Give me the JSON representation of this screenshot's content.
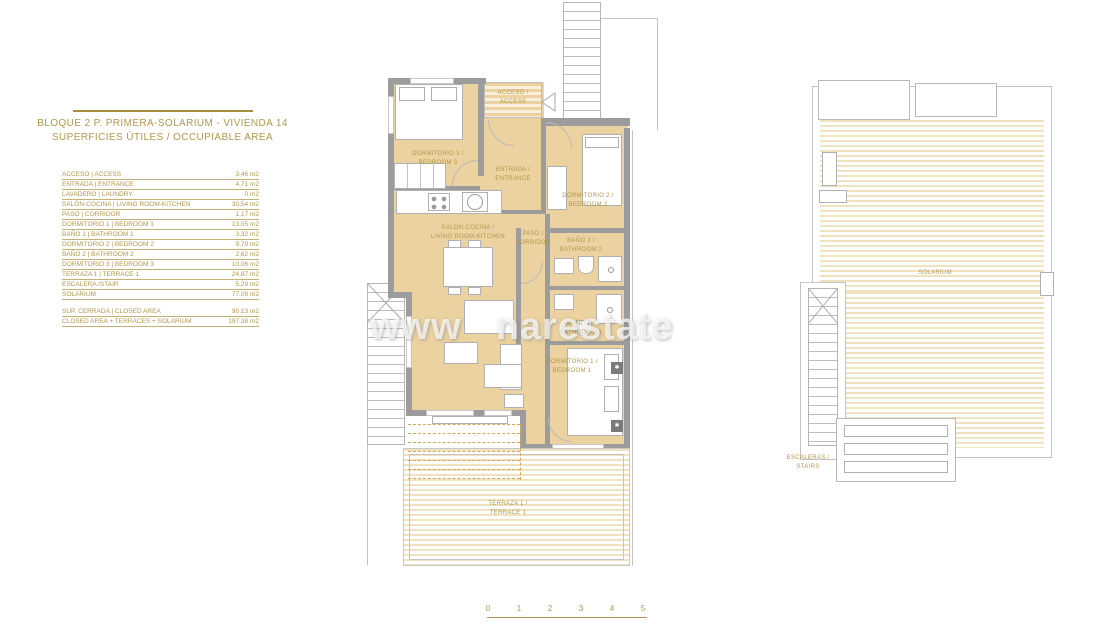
{
  "header": {
    "title_line1": "BLOQUE 2 P. PRIMERA-SOLARIUM - VIVIENDA 14",
    "title_line2": "SUPERFICIES ÚTILES / OCCUPIABLE AREA"
  },
  "area_table": {
    "rows": [
      {
        "label": "ACCESO | ACCESS",
        "value": "3,46 m2"
      },
      {
        "label": "ENTRADA | ENTRANCE",
        "value": "4,71 m2"
      },
      {
        "label": "LAVADERO | LAUNDRY",
        "value": "0 m2"
      },
      {
        "label": "SALÓN-COCINA | LIVING ROOM-KITCHEN",
        "value": "30,54 m2"
      },
      {
        "label": "PASO | CORRIDOR",
        "value": "1,17 m2"
      },
      {
        "label": "DORMITORIO 1 | BEDROOM 1",
        "value": "13,05 m2"
      },
      {
        "label": "BAÑO 1 | BATHROOM 1",
        "value": "3,32 m2"
      },
      {
        "label": "DORMITORIO 2 | BEDROOM 2",
        "value": "9,79 m2"
      },
      {
        "label": "BAÑO 2 | BATHROOM 2",
        "value": "2,62 m2"
      },
      {
        "label": "DORMITORIO 3 | BEDROOM 3",
        "value": "10,06 m2"
      },
      {
        "label": "TERRAZA 1 | TERRACE 1",
        "value": "24,87 m2"
      },
      {
        "label": "ESCALERA /STAIR",
        "value": "5,29 m2"
      },
      {
        "label": "SOLARIUM",
        "value": "77,09 m2"
      }
    ],
    "summary": [
      {
        "label": "SUP. CERRADA | CLOSED AREA",
        "value": "90,13 m2"
      },
      {
        "label": "CLOSED AREA + TERRACES + SOLARIUM",
        "value": "197,38 m2"
      }
    ]
  },
  "floorplan": {
    "labels": {
      "acceso": "ACCESO /\nACCESS",
      "bedroom3": "DORMITORIO 3 /\nBEDROOM 3",
      "entrada": "ENTRADA /\nENTRANCE",
      "bedroom2": "DORMITORIO 2 /\nBEDROOM 2",
      "salon": "SALÓN-COCINA /\nLIVING ROOM-KITCHEN",
      "paso": "PASO /\nCORRIDOR",
      "bath2": "BAÑO 2 /\nBATHROOM 2",
      "bath1": "BAÑO 1 /\nBATHROOM 1",
      "bedroom1": "DORMITORIO 1 /\nBEDROOM 1",
      "terrace": "TERRAZA 1 /\nTERRACE 1"
    }
  },
  "solarium_plan": {
    "labels": {
      "solarium": "SOLARIUM",
      "stairs": "ESCALERAS /\nSTAIRS"
    }
  },
  "scalebar": {
    "ticks": [
      "0",
      "1",
      "2",
      "3",
      "4",
      "5"
    ]
  },
  "watermark": {
    "part1": "www",
    "part2": "narestate"
  },
  "colors": {
    "accent_gold": "#b2974b",
    "room_fill": "#ebd2a0",
    "wall_gray": "#9c9c9c"
  }
}
